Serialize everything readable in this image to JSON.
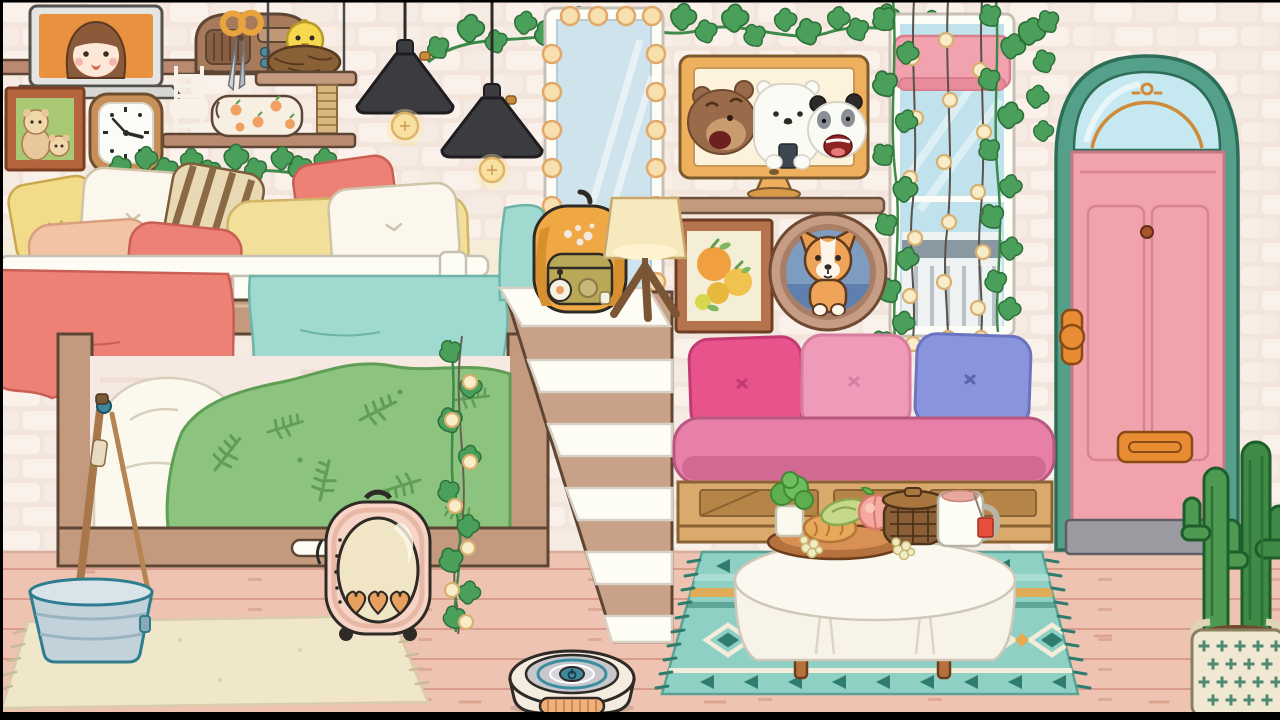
{
  "scene": {
    "style": "toca-life-room",
    "door": {
      "number": "249"
    },
    "backpack": {
      "brand_label": "Vans"
    },
    "palette": {
      "wall": "#f3e4dc",
      "brick_light": "#faf1ea",
      "brick_mid": "#f6ebe3",
      "floor": "#efc3b1",
      "floor_line": "#d79c8a",
      "wood": "#c49a7e",
      "wood_dark": "#5e4634",
      "shelf_wood": "#b98a6f",
      "door_frame_teal": "#55a08a",
      "door_pink": "#f2a2ac",
      "door_sign_orange": "#cf8a3a",
      "accent_orange": "#e88c34",
      "tv_frame": "#eeb05c",
      "lamp_black": "#3c3c40",
      "bulb_warm": "#f9ecc8",
      "ivy_green": "#4aa05a",
      "blanket_teal": "#9fd9cf",
      "blanket_green": "#8cc37e",
      "fern_green": "#5f9e54",
      "pillow_yellow": "#f2dc8a",
      "pillow_coral": "#ee8176",
      "pillow_peach": "#f2c4a4",
      "sofa_pink": "#e87fa8",
      "cushion_magenta": "#e8538c",
      "cushion_pink": "#ef9ab8",
      "cushion_periwinkle": "#8a94dc",
      "pallet_wood": "#d9aa6b",
      "rug_teal": "#8ed0c4",
      "rug_dark_teal": "#2e7d6e",
      "rug_orange": "#e8a84e",
      "rug_cream": "#f0e7cb",
      "carrier_pink": "#f7d4c6",
      "bucket_grey": "#c2d2da",
      "backpack_orange": "#f0a844",
      "cactus_green": "#3e8a46"
    },
    "objects": [
      "laptop showing girl",
      "wooden radio",
      "scissors",
      "bird nest swing shelf",
      "cat-tree post",
      "ladder",
      "peach pencil case",
      "family portrait",
      "wall clock",
      "ivy garlands",
      "two black pendant lamps",
      "light-bulb mirror",
      "bunk bed with pillows",
      "teal blanket",
      "coral blanket",
      "fern duvet",
      "white staircase",
      "Vans backpack",
      "tripod lamp",
      "TV showing three bears",
      "oranges painting",
      "dog in porthole bed",
      "window with string lights and pink blind",
      "teal arch door 249",
      "pallet sofa with three cushions",
      "round cloth table",
      "food tray",
      "herb pot",
      "peach",
      "picnic basket",
      "tea mug",
      "kilim teal rug",
      "cream rug",
      "pet carrier with hearts",
      "stick in metal bucket",
      "robot vacuum",
      "cactus in basket"
    ]
  }
}
